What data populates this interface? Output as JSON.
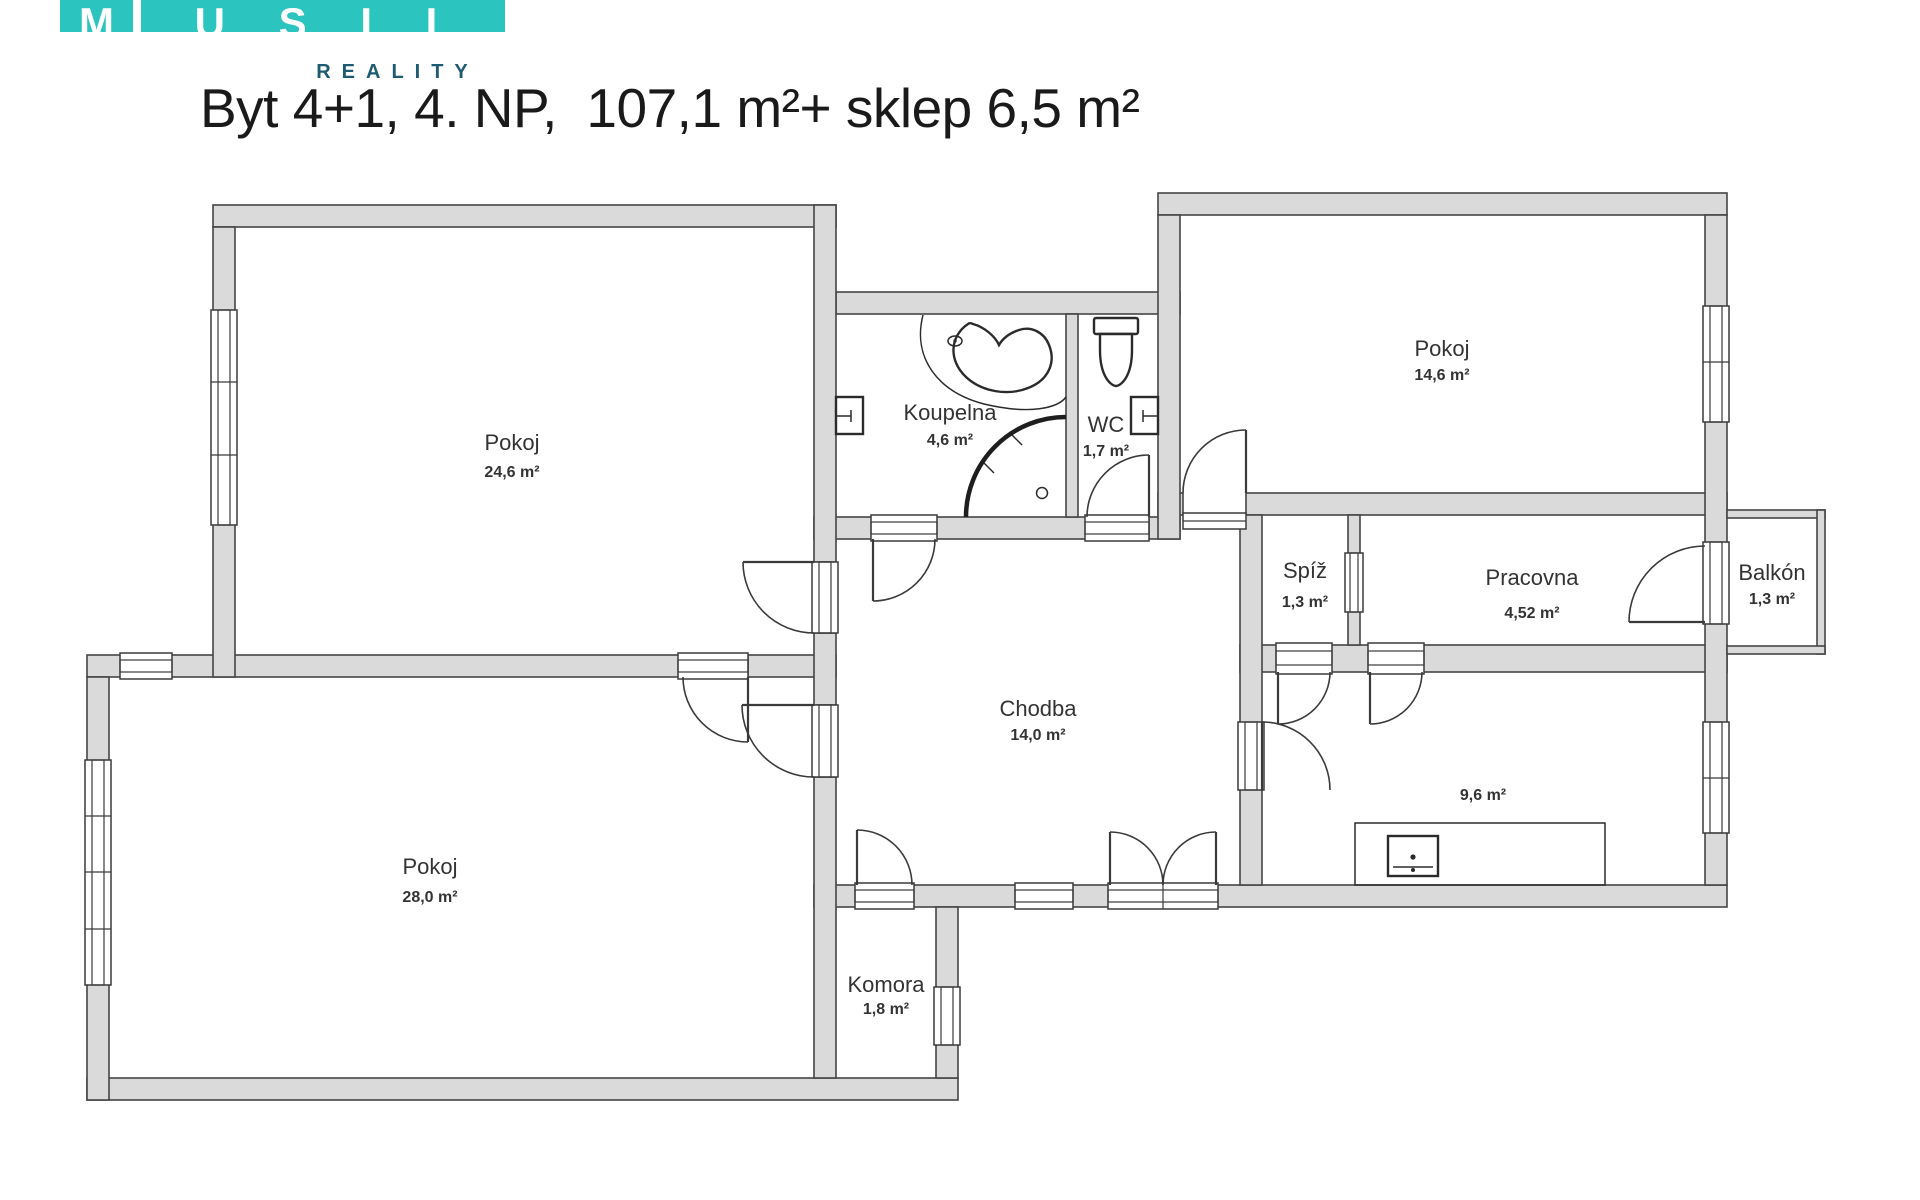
{
  "logo": {
    "letters": [
      "M",
      "U",
      "S",
      "I",
      "L"
    ],
    "subtitle": "REALITY"
  },
  "title": "Byt 4+1, 4. NP,  107,1 m²+ sklep 6,5 m²",
  "rooms": [
    {
      "id": "pokoj-1",
      "name": "Pokoj",
      "area": "24,6 m²"
    },
    {
      "id": "pokoj-2",
      "name": "Pokoj",
      "area": "28,0 m²"
    },
    {
      "id": "koupelna",
      "name": "Koupelna",
      "area": "4,6 m²"
    },
    {
      "id": "wc",
      "name": "WC",
      "area": "1,7 m²"
    },
    {
      "id": "pokoj-3",
      "name": "Pokoj",
      "area": "14,6 m²"
    },
    {
      "id": "spiz",
      "name": "Spíž",
      "area": "1,3 m²"
    },
    {
      "id": "pracovna",
      "name": "Pracovna",
      "area": "4,52 m²"
    },
    {
      "id": "balkon",
      "name": "Balkón",
      "area": "1,3 m²"
    },
    {
      "id": "chodba",
      "name": "Chodba",
      "area": "14,0 m²"
    },
    {
      "id": "kuchyn",
      "name": "",
      "area": "9,6 m²"
    },
    {
      "id": "komora",
      "name": "Komora",
      "area": "1,8 m²"
    }
  ],
  "colors": {
    "wall-fill": "#dadada",
    "wall-stroke": "#454545",
    "teal": "#2bc4bf",
    "subtitle": "#1e5a72"
  }
}
